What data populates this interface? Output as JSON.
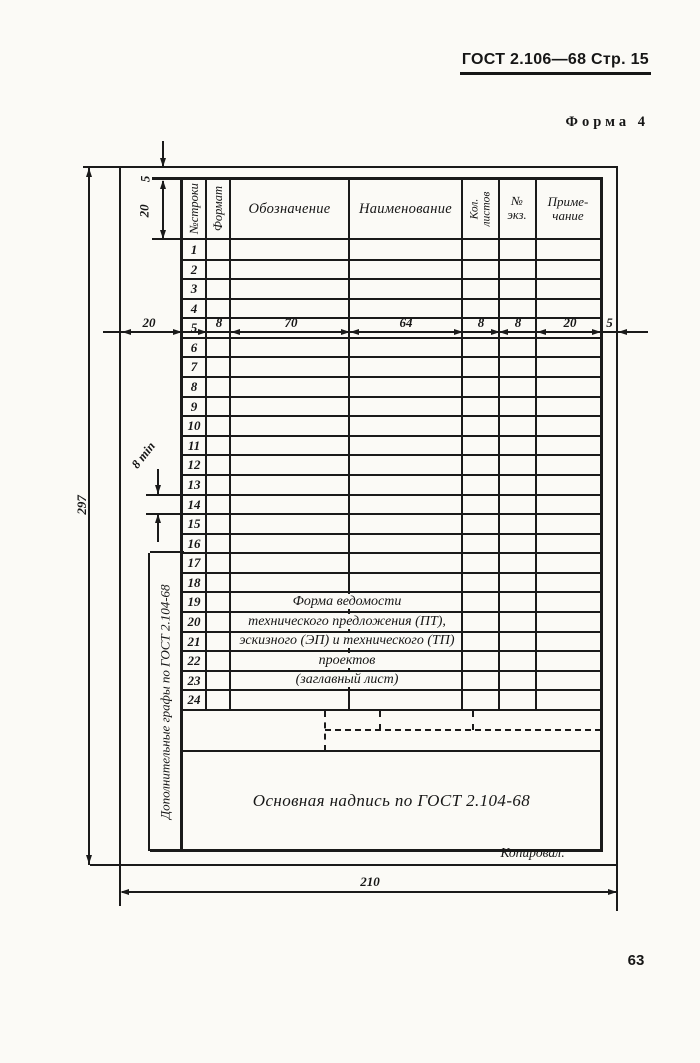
{
  "page": {
    "doc_header": "ГОСТ 2.106—68 Стр. 15",
    "form_label": "Форма 4",
    "page_number": "63",
    "copied_label": "Копировал:"
  },
  "form": {
    "columns": [
      "№строки",
      "Формат",
      "Обозначение",
      "Наименование",
      "Кол.\nлистов",
      "№\nэкз.",
      "Приме-\nчание"
    ],
    "row_numbers": [
      "1",
      "2",
      "3",
      "4",
      "5",
      "6",
      "7",
      "8",
      "9",
      "10",
      "11",
      "12",
      "13",
      "14",
      "15",
      "16",
      "17",
      "18",
      "19",
      "20",
      "21",
      "22",
      "23",
      "24"
    ],
    "center_note_lines": [
      "Форма ведомости",
      "технического предложения (ПТ),",
      "эскизного (ЭП) и технического (ТП)",
      "проектов",
      "(заглавный лист)"
    ],
    "title_block_label": "Основная надпись по ГОСТ 2.104-68",
    "side_note": "Дополнительные графы по ГОСТ 2.104-68"
  },
  "dimensions": {
    "top_margin": "5",
    "header_height": "20",
    "left_margin": "20",
    "format_col": "8",
    "designation_col": "70",
    "name_col": "64",
    "sheets_col": "8",
    "copy_col": "8",
    "note_col": "20",
    "right_margin": "5",
    "row_height_min": "8 min",
    "sheet_height": "297",
    "sheet_width": "210"
  }
}
